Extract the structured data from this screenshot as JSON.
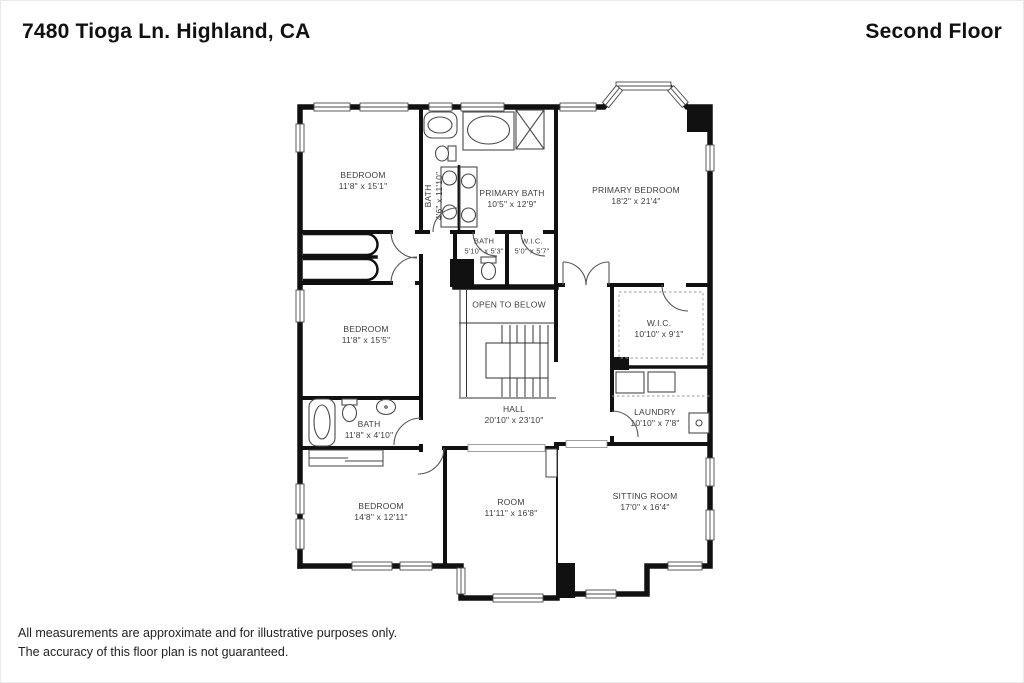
{
  "header": {
    "address": "7480 Tioga Ln. Highland, CA",
    "floor": "Second Floor"
  },
  "disclaimer": {
    "line1": "All measurements are approximate and for illustrative purposes only.",
    "line2": "The accuracy of this floor plan is not guaranteed."
  },
  "rooms": {
    "bedroom_top": {
      "name": "BEDROOM",
      "dims": "11'8\" x 15'1\""
    },
    "bath_hall": {
      "name": "BATH",
      "dims": "4'6\" x 11'10\""
    },
    "primary_bath": {
      "name": "PRIMARY BATH",
      "dims": "10'5\" x 12'9\""
    },
    "primary_bedroom": {
      "name": "PRIMARY BEDROOM",
      "dims": "18'2\" x 21'4\""
    },
    "bath_small": {
      "name": "BATH",
      "dims": "5'10\" x 5'3\""
    },
    "wic_small": {
      "name": "W.I.C.",
      "dims": "5'0\" x 5'7\""
    },
    "open_to_below": {
      "name": "OPEN TO BELOW"
    },
    "bedroom_mid": {
      "name": "BEDROOM",
      "dims": "11'8\" x 15'5\""
    },
    "wic_primary": {
      "name": "W.I.C.",
      "dims": "10'10\" x 9'1\""
    },
    "hall": {
      "name": "HALL",
      "dims": "20'10\" x 23'10\""
    },
    "laundry": {
      "name": "LAUNDRY",
      "dims": "10'10\" x 7'8\""
    },
    "bath_lower": {
      "name": "BATH",
      "dims": "11'8\" x 4'10\""
    },
    "bedroom_bottom": {
      "name": "BEDROOM",
      "dims": "14'8\" x 12'11\""
    },
    "room": {
      "name": "ROOM",
      "dims": "11'11\" x 16'8\""
    },
    "sitting_room": {
      "name": "SITTING ROOM",
      "dims": "17'0\" x 16'4\""
    }
  },
  "colors": {
    "wall": "#111111",
    "fixture_line": "#4a4a4a",
    "text": "#3d3d3d",
    "background": "#ffffff"
  }
}
